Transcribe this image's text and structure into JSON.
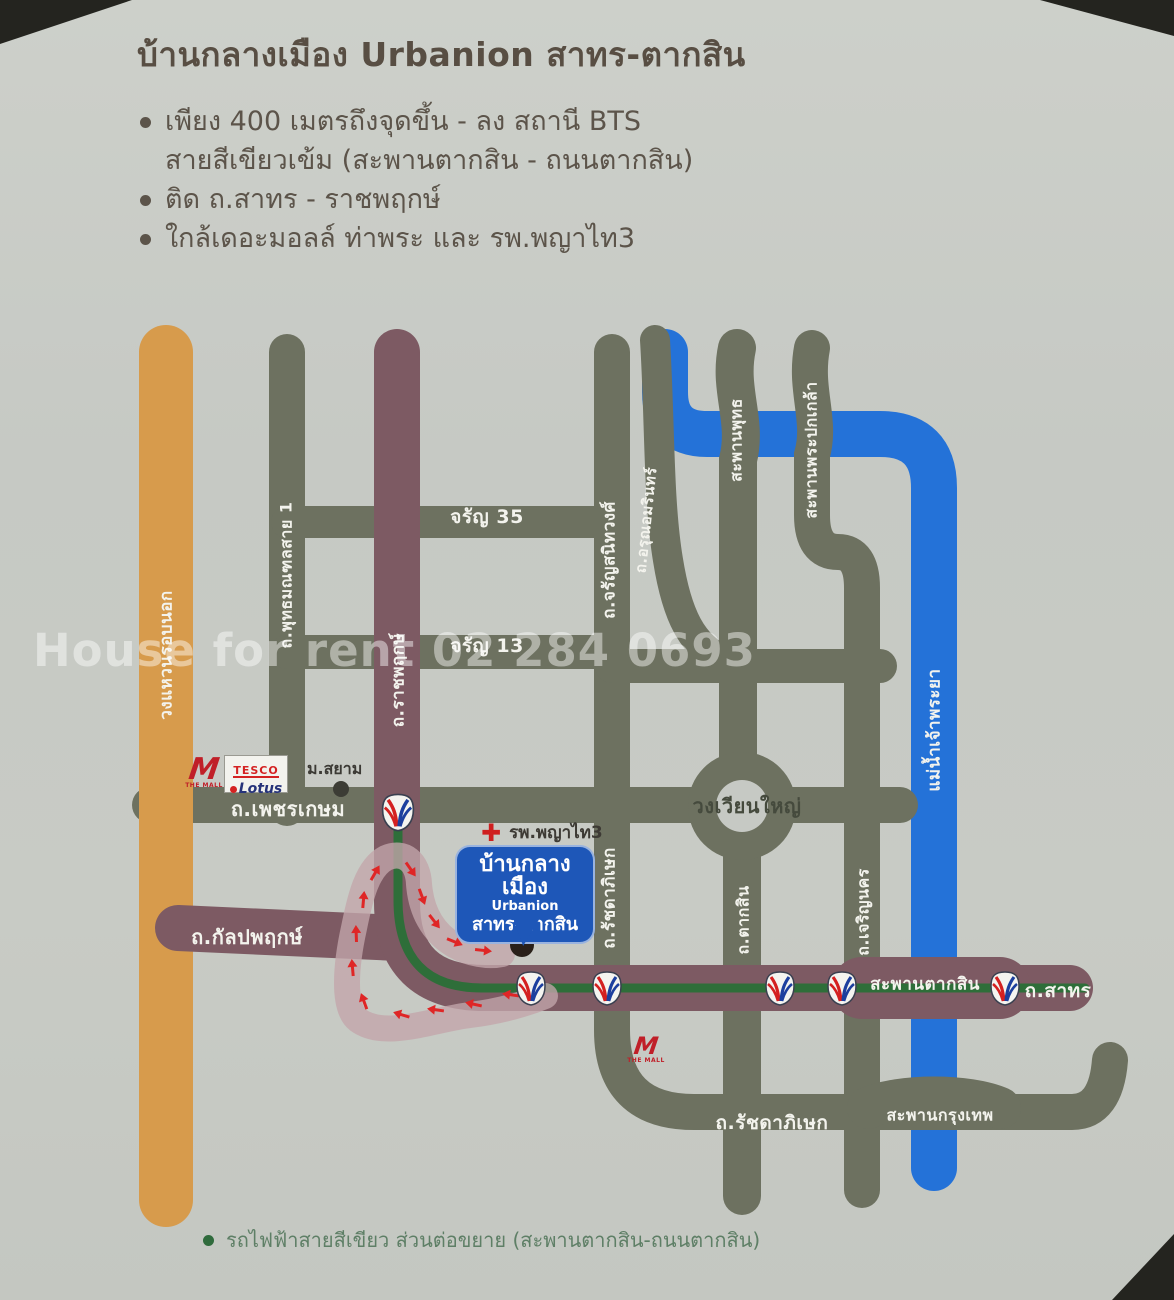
{
  "header": {
    "title": "บ้านกลางเมือง Urbanion สาทร-ตากสิน",
    "bullets": [
      {
        "lines": [
          "เพียง 400 เมตรถึงจุดขึ้น - ลง สถานี BTS",
          "สายสีเขียวเข้ม (สะพานตากสิน - ถนนตากสิน)"
        ]
      },
      {
        "lines": [
          "ติด ถ.สาทร - ราชพฤกษ์"
        ]
      },
      {
        "lines": [
          "ใกล้เดอะมอลล์ ท่าพระ และ รพ.พญาไท3"
        ]
      }
    ]
  },
  "watermark": "House for rent 02 284 0693",
  "map": {
    "labels": {
      "ring_road": "วงแหวนรอบนอก",
      "phutthamonthon": "ถ.พุทธมณฑลสาย 1",
      "charan35": "จรัญ 35",
      "charan13": "จรัญ 13",
      "charansanitwong": "ถ.จรัญสนิทวงศ์",
      "arun_amarin": "ถ.อรุณอมรินทร์",
      "saphan_phut": "สะพานพุทธ",
      "saphan_phra_pok_klao": "สะพานพระปกเกล้า",
      "chao_phraya": "แม่น้ำเจ้าพระยา",
      "phetkasem": "ถ.เพชรเกษม",
      "ratchaphruek": "ถ.ราชพฤกษ์",
      "wongwian_yai": "วงเวียนใหญ่",
      "ratchadaphisek_v": "ถ.รัชดาภิเษก",
      "taksin_rd": "ถ.ตากสิน",
      "charoen_nakhon": "ถ.เจริญนคร",
      "kanlapaphruek": "ถ.กัลปพฤกษ์",
      "saphan_taksin": "สะพานตากสิน",
      "sathorn": "ถ.สาทร",
      "ratchadaphisek_h": "ถ.รัชดาภิเษก",
      "saphan_krungthep": "สะพานกรุงเทพ"
    },
    "pois": {
      "siam_university": "ม.สยาม",
      "phyathai3": "รพ.พญาไท3",
      "the_mall_m": "M",
      "the_mall": "THE MALL",
      "tesco": "TESCO",
      "lotus": "Lotus"
    },
    "callout": {
      "line1": "บ้านกลางเมือง",
      "line2": "Urbanion",
      "line3": "สาทร-ตากสิน"
    },
    "legend": "รถไฟฟ้าสายสีเขียว ส่วนต่อขยาย (สะพานตากสิน-ถนนตากสิน)"
  },
  "colors": {
    "olive": "#6d7160",
    "orange": "#d79b4c",
    "purple": "#7d5a63",
    "river": "#2472d8",
    "btsgreen": "#2e6e39",
    "routepink": "#c3a5ab",
    "arrowred": "#df2626",
    "callout": "#1e57b8"
  }
}
